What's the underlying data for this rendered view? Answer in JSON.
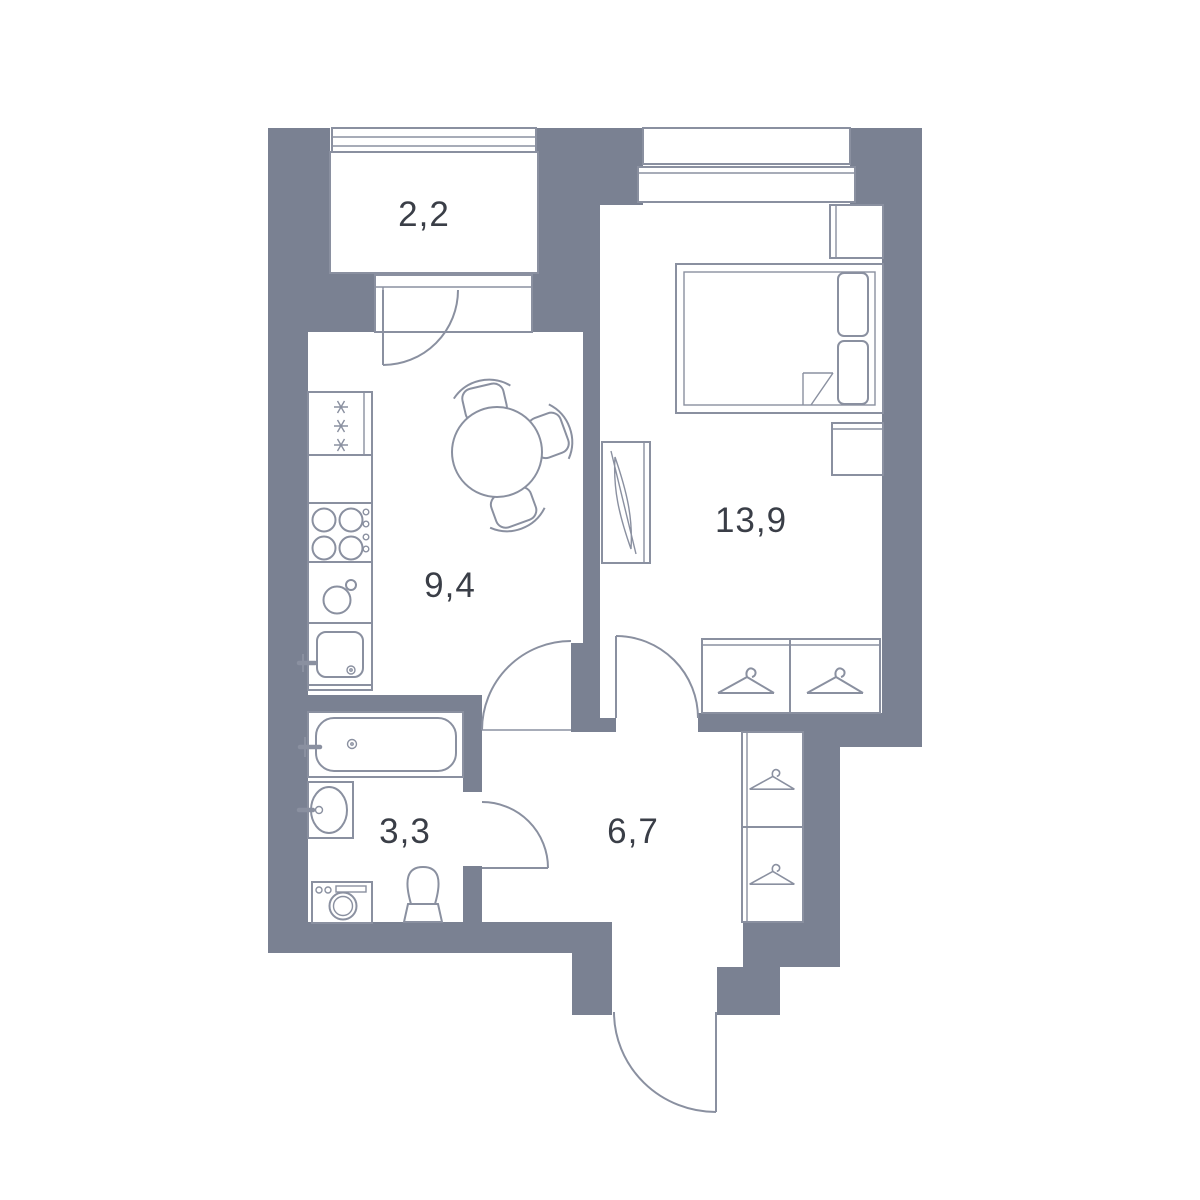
{
  "plan": {
    "kind": "apartment floor plan",
    "units_note": "room areas as shown on plan"
  },
  "colors": {
    "wall": "#7A8192",
    "line": "#8A90A0",
    "text": "#3A3E47",
    "bg": "#FFFFFF"
  },
  "rooms": {
    "balcony": {
      "area": "2,2"
    },
    "kitchen": {
      "area": "9,4"
    },
    "bedroom": {
      "area": "13,9"
    },
    "bathroom": {
      "area": "3,3"
    },
    "hallway": {
      "area": "6,7"
    }
  }
}
